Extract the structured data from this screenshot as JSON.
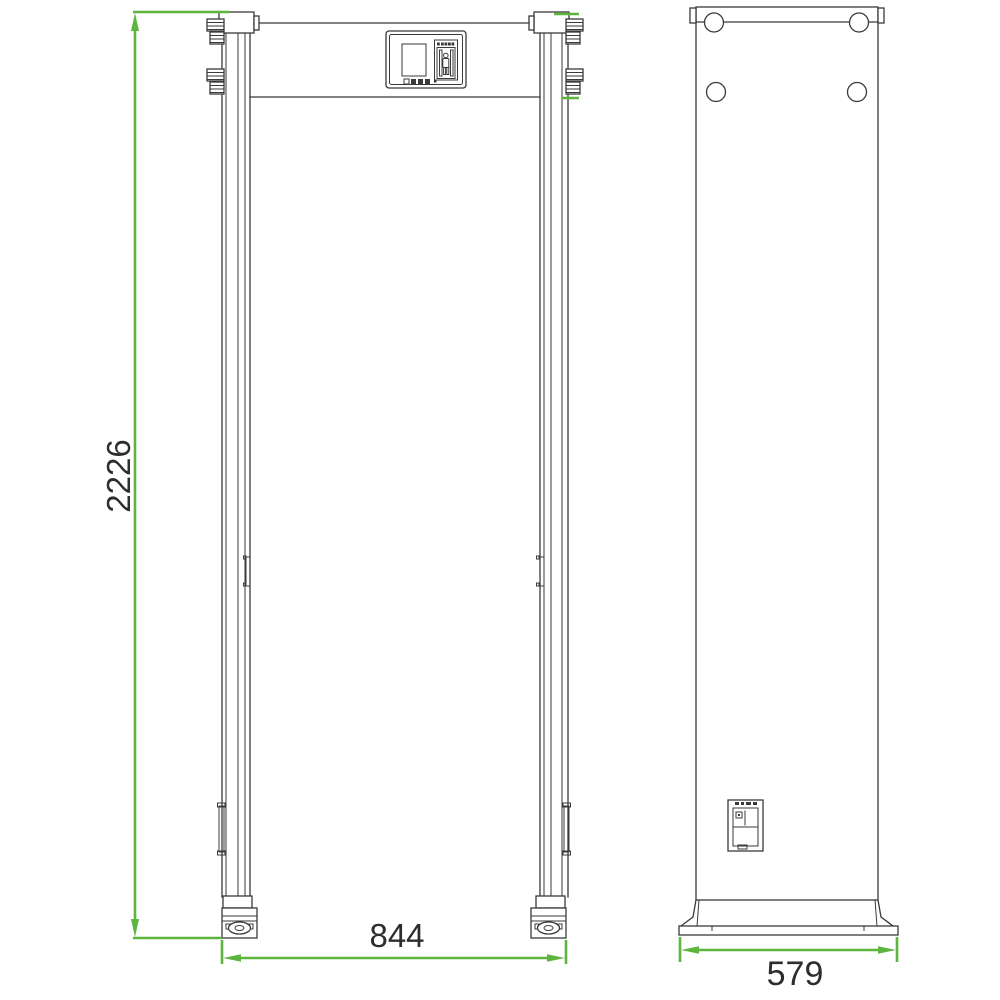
{
  "drawing": {
    "front_view": {
      "height_dim": "2226",
      "width_dim": "844"
    },
    "side_view": {
      "depth_dim": "579"
    }
  },
  "colors": {
    "dimension_green": "#5db53e",
    "drawing_line": "#3a3a3a",
    "background": "#ffffff",
    "text": "#2d2d2d"
  }
}
